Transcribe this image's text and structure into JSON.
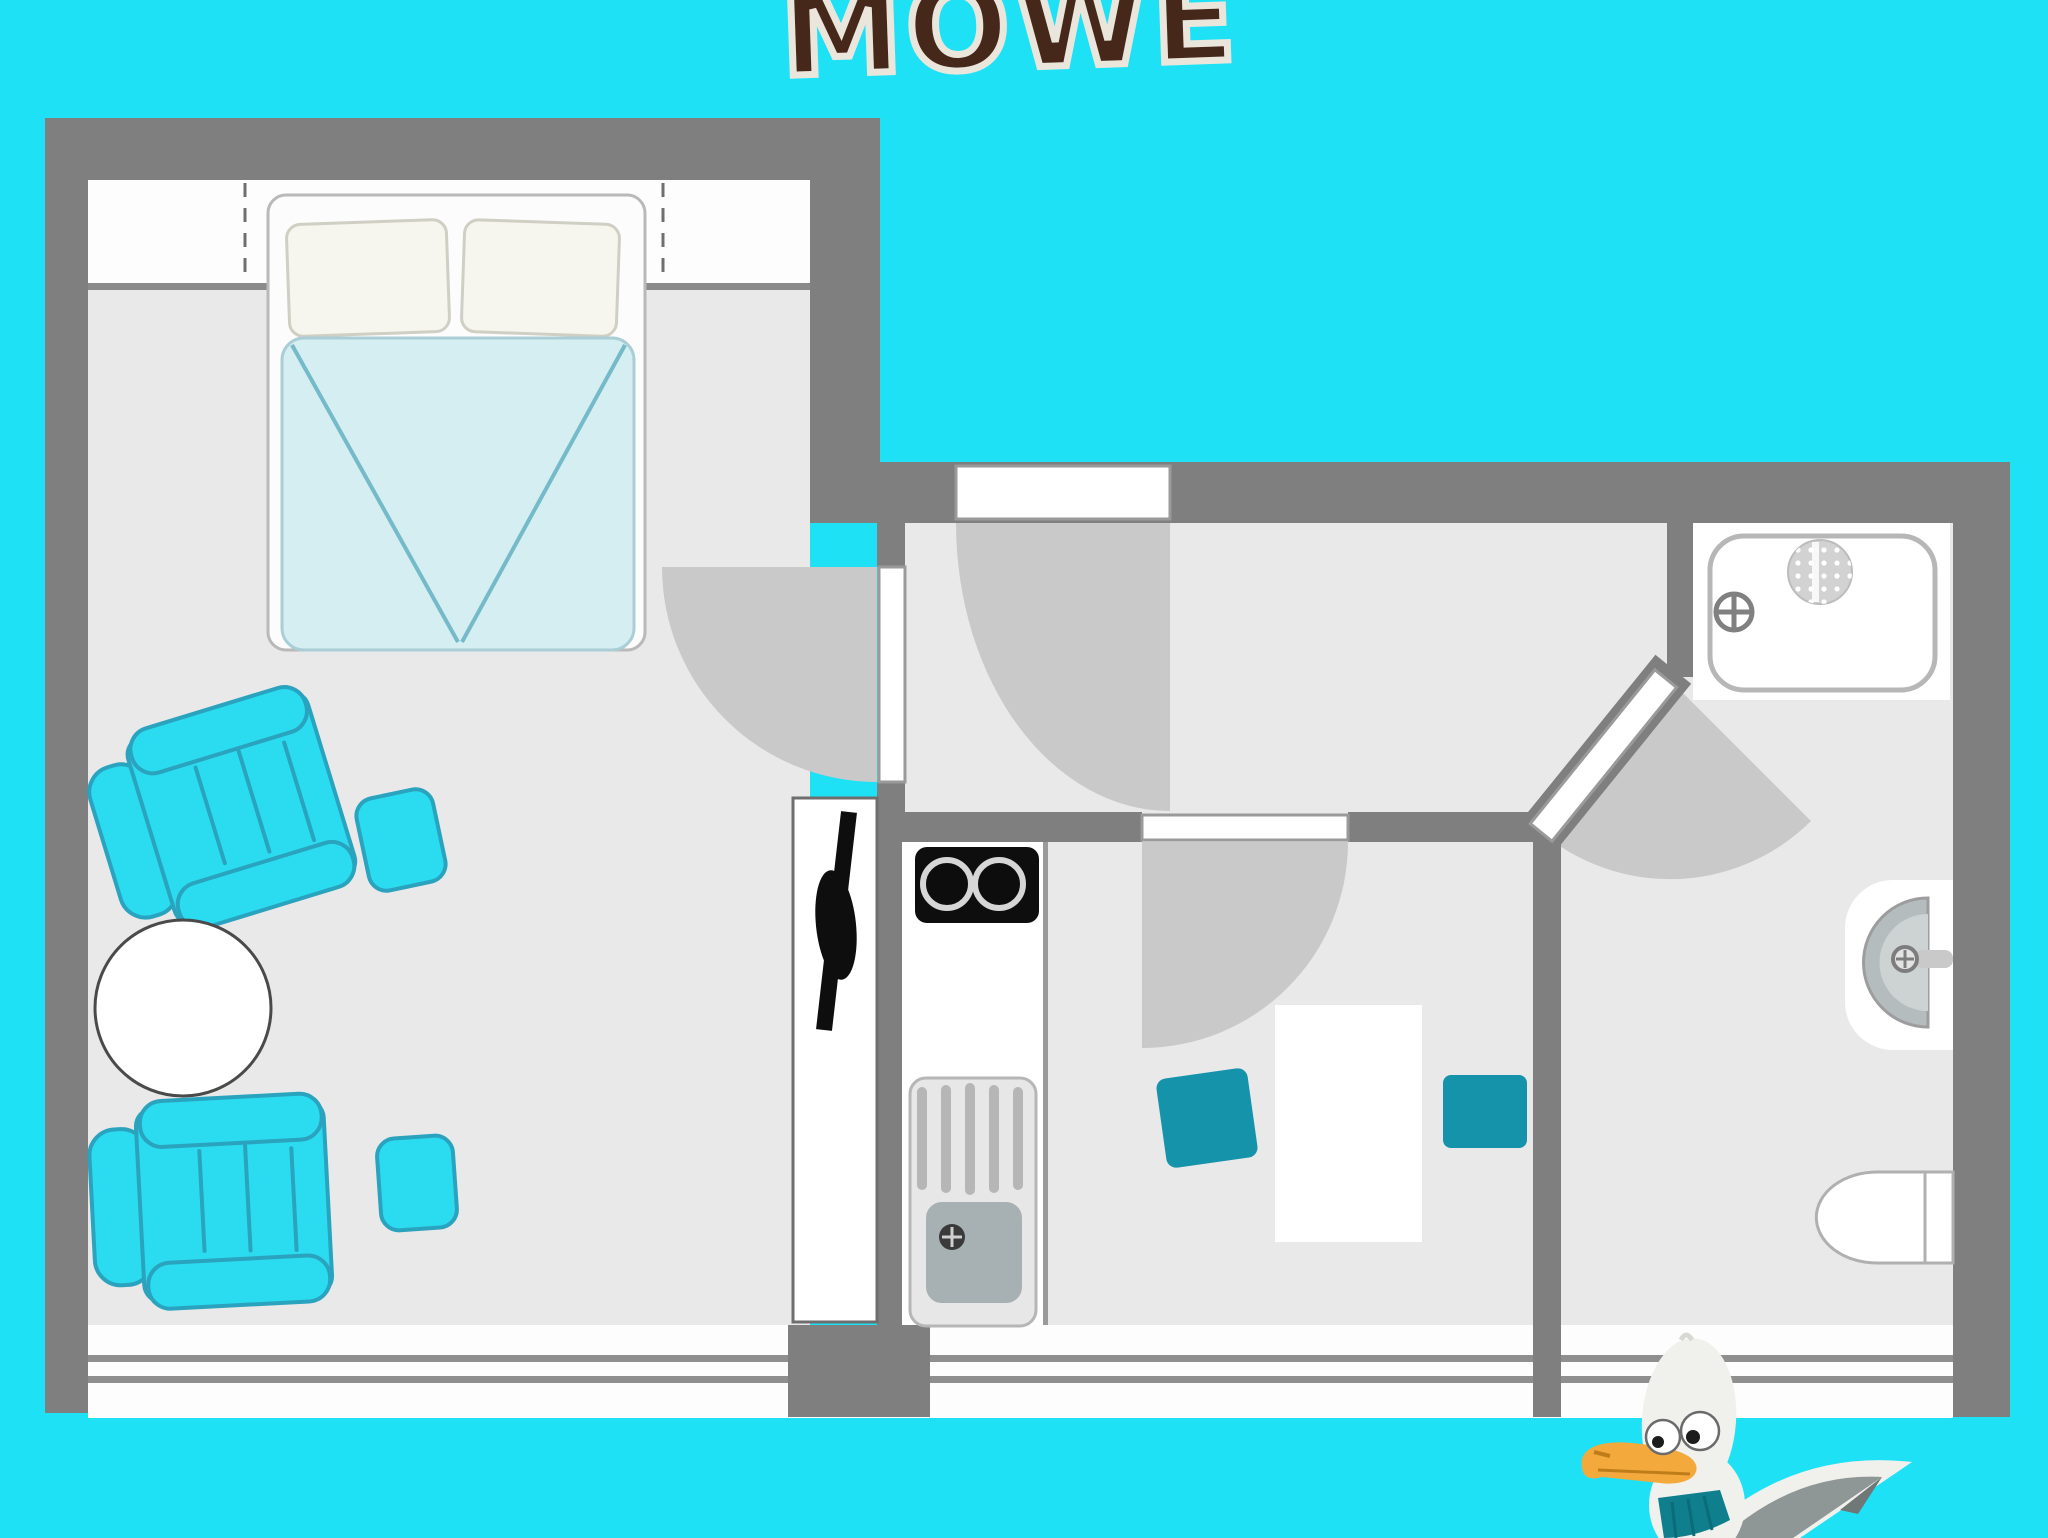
{
  "title": {
    "text": "MÖWE"
  },
  "colors": {
    "bg": "#1ee1f6",
    "wall": "#7f7f7f",
    "wallEdge": "#8a8a8a",
    "floor": "#e9e9e9",
    "swing": "#c9c9c9",
    "window": "#fdfdfd",
    "windowLine": "#8f8f8f",
    "windowDash": "#6f6f6f",
    "doorLeaf": "#ffffff",
    "doorBorder": "#9a9a9a",
    "bedFrame": "#fcfcfc",
    "bedBorder": "#b9b9b9",
    "pillow": "#f6f6ee",
    "pillowBorder": "#cfcfc4",
    "blanket": "#d5eef2",
    "blanketBorder": "#a9ced6",
    "blanketLine": "#74bac9",
    "chair": "#2bdcf1",
    "chairBorder": "#2aa3be",
    "tealChair": "#1593ab",
    "tableFill": "#ffffff",
    "tableBorder": "#4a4a4a",
    "black": "#0e0e0e",
    "metal": "#e7e7e7",
    "metalDark": "#b6b6b6",
    "basin": "#a7b1b3",
    "counterEdge": "#9a9a9a",
    "tub": "#ffffff",
    "tubBorder": "#b7b7b7",
    "fixtureLine": "#808080",
    "beak": "#f3a93c",
    "beakDark": "#bf7d1a",
    "scarf": "#0f7e8d",
    "gullBody": "#f0f0ec",
    "gullGray": "#8f9696",
    "gullDark": "#6f7777",
    "titleColor": "#46281b",
    "titleOutline": "#eae6db",
    "pupil": "#1c1c1c"
  },
  "icons": {
    "bed": "double-bed-top-view",
    "armchair": "armchair-top-view",
    "ottoman": "ottoman-stool",
    "round_table": "round-side-table",
    "wardrobe": "wardrobe-clothes-rail",
    "stove": "two-burner-cooktop",
    "kitchen_sink": "kitchen-sink-with-drainboard",
    "dining_table": "rectangular-table",
    "dining_chair": "chair-top-view",
    "bathtub": "bathtub-with-shower",
    "bath_sink": "wall-mounted-washbasin",
    "toilet": "toilet-top-view",
    "door_swing": "door-swing-arc",
    "mascot": "cartoon-seagull"
  }
}
